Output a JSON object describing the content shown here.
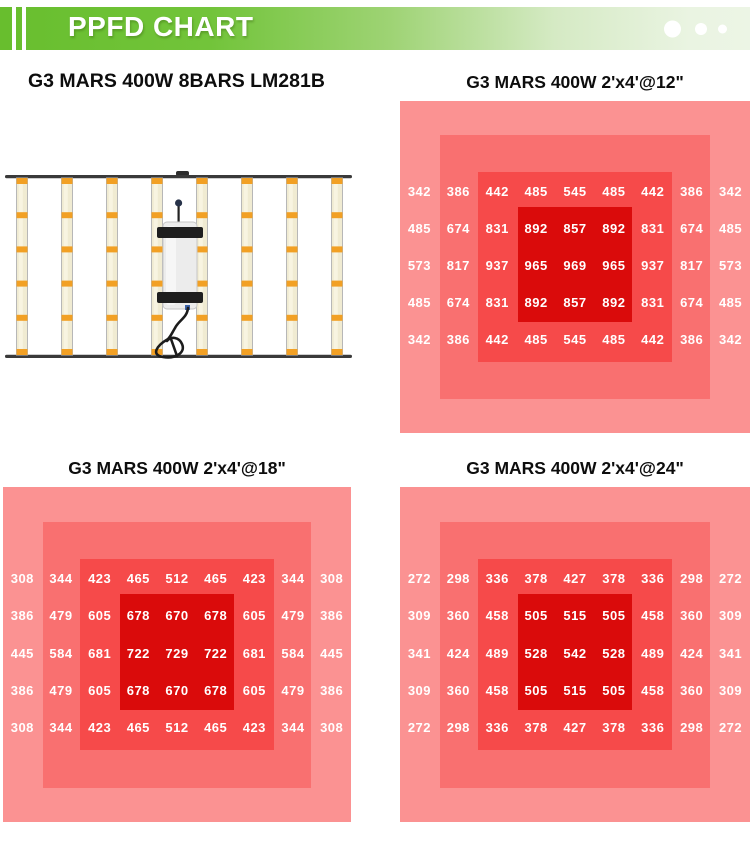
{
  "header": {
    "title": "PPFD CHART",
    "accent_green": "#68be2e",
    "dot_count": 3
  },
  "panels": {
    "fixture": {
      "title": "G3 MARS 400W 8BARS LM281B",
      "bar_count": 8
    }
  },
  "palette": {
    "heat_level_1": "#fb9292",
    "heat_level_2": "#f97070",
    "heat_level_3": "#f64a4a",
    "heat_level_4": "#da0b0b",
    "value_text": "#ffffff"
  },
  "chart_data": [
    {
      "type": "heatmap",
      "title": "G3 MARS 400W 2'x4'@12\"",
      "coverage": "2'x4'",
      "mounting_height": "12\"",
      "rows": 5,
      "cols": 9,
      "values": [
        [
          342,
          386,
          442,
          485,
          545,
          485,
          442,
          386,
          342
        ],
        [
          485,
          674,
          831,
          892,
          857,
          892,
          831,
          674,
          485
        ],
        [
          573,
          817,
          937,
          965,
          969,
          965,
          937,
          817,
          573
        ],
        [
          485,
          674,
          831,
          892,
          857,
          892,
          831,
          674,
          485
        ],
        [
          342,
          386,
          442,
          485,
          545,
          485,
          442,
          386,
          342
        ]
      ]
    },
    {
      "type": "heatmap",
      "title": "G3 MARS 400W 2'x4'@18\"",
      "coverage": "2'x4'",
      "mounting_height": "18\"",
      "rows": 5,
      "cols": 9,
      "values": [
        [
          308,
          344,
          423,
          465,
          512,
          465,
          423,
          344,
          308
        ],
        [
          386,
          479,
          605,
          678,
          670,
          678,
          605,
          479,
          386
        ],
        [
          445,
          584,
          681,
          722,
          729,
          722,
          681,
          584,
          445
        ],
        [
          386,
          479,
          605,
          678,
          670,
          678,
          605,
          479,
          386
        ],
        [
          308,
          344,
          423,
          465,
          512,
          465,
          423,
          344,
          308
        ]
      ]
    },
    {
      "type": "heatmap",
      "title": "G3 MARS 400W 2'x4'@24\"",
      "coverage": "2'x4'",
      "mounting_height": "24\"",
      "rows": 5,
      "cols": 9,
      "values": [
        [
          272,
          298,
          336,
          378,
          427,
          378,
          336,
          298,
          272
        ],
        [
          309,
          360,
          458,
          505,
          515,
          505,
          458,
          360,
          309
        ],
        [
          341,
          424,
          489,
          528,
          542,
          528,
          489,
          424,
          341
        ],
        [
          309,
          360,
          458,
          505,
          515,
          505,
          458,
          360,
          309
        ],
        [
          272,
          298,
          336,
          378,
          427,
          378,
          336,
          298,
          272
        ]
      ]
    }
  ]
}
